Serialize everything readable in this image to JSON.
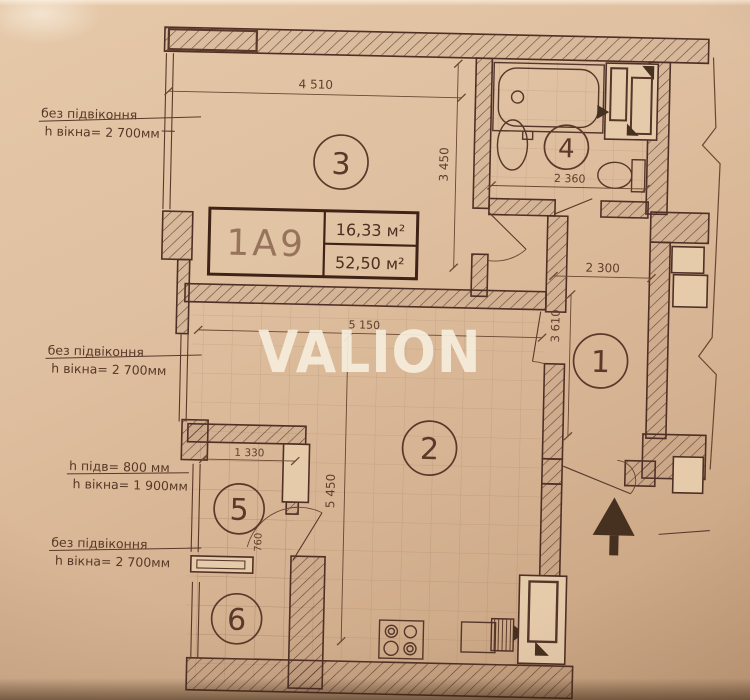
{
  "watermark": "VALION",
  "title_block": {
    "unit": "1А9",
    "room_area": "16,33 м²",
    "total_area": "52,50 м²"
  },
  "room_numbers": {
    "hall": "1",
    "living": "2",
    "bedroom": "3",
    "bathroom": "4",
    "room5": "5",
    "room6": "6"
  },
  "dimensions": {
    "bedroom_width": "4 510",
    "bedroom_depth": "3 450",
    "bathroom_width": "2 360",
    "hall_width": "2 300",
    "hall_depth": "3 610",
    "living_width": "5 150",
    "living_depth": "5 450",
    "room5_width": "1 330",
    "door_width": "760"
  },
  "annotations": {
    "bedroom_window": {
      "line1": "без підвіконня",
      "line2": "h вікна= 2 700мм"
    },
    "living_window": {
      "line1": "без підвіконня",
      "line2": "h вікна= 2 700мм"
    },
    "room5_window": {
      "line1": "h підв= 800 мм",
      "line2": "h вікна= 1 900мм"
    },
    "room6_window": {
      "line1": "без підвіконня",
      "line2": "h вікна= 2 700мм"
    }
  },
  "colors": {
    "paper": "#dcbd9d",
    "ink": "#4f3026",
    "watermark_fill": "#f2e7d2",
    "arrow_fill": "#46301f"
  }
}
